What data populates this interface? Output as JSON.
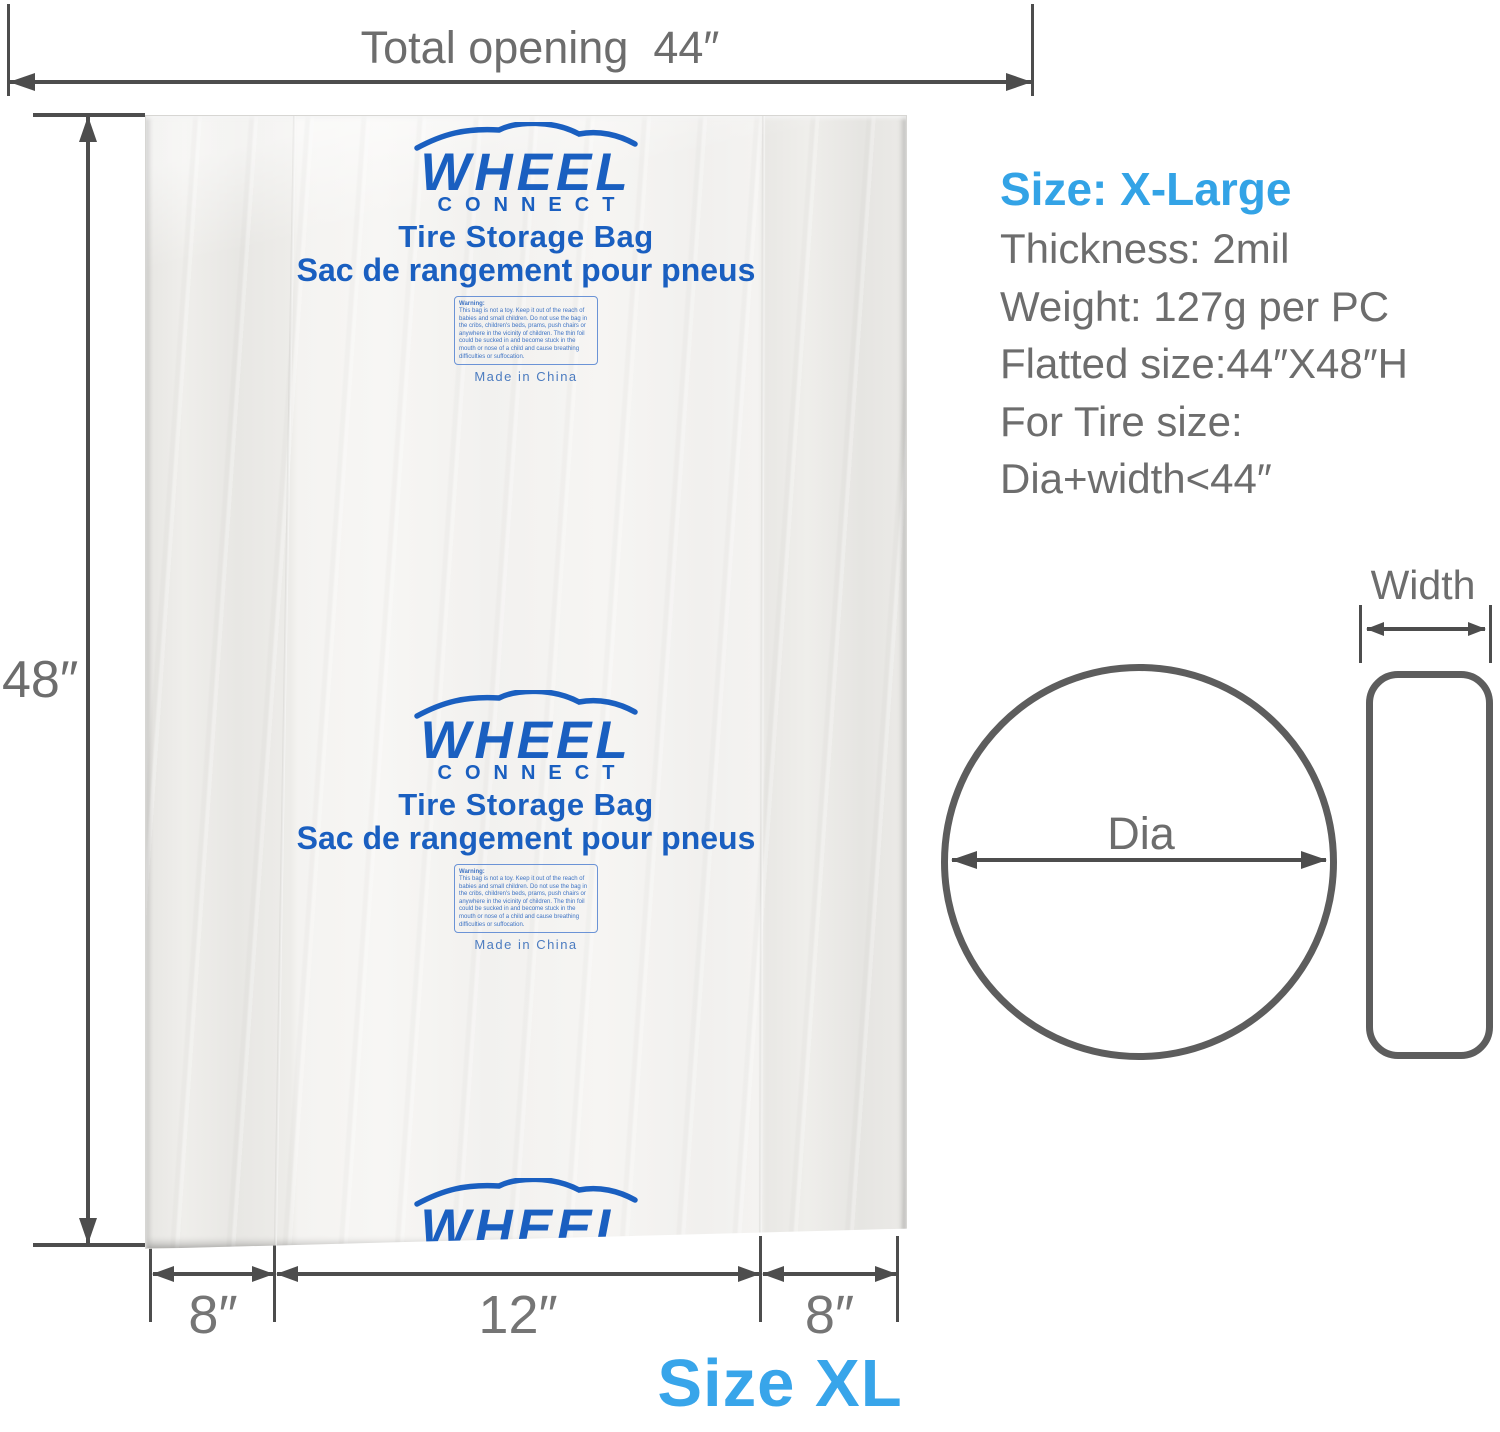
{
  "top_dimension": {
    "label": "Total opening  44″"
  },
  "left_dimension": {
    "label": "48″"
  },
  "bag": {
    "logo": {
      "brand": "WHEEL",
      "sub_brand": "CONNECT",
      "product_en": "Tire Storage Bag",
      "product_fr": "Sac de rangement pour pneus",
      "warning_title": "Warning:",
      "warning_text": "This bag is not a toy. Keep it out of the reach of babies and small children. Do not use the bag in the cribs, children's beds, prams, push chairs or anywhere in the vicinity of children. The thin foil could be sucked in and become stuck in the mouth or nose of a child and cause breathing difficulties or suffocation.",
      "origin": "Made in China"
    }
  },
  "bottom_dimension": {
    "left": "8″",
    "middle": "12″",
    "right": "8″"
  },
  "size_caption": "Size XL",
  "specs": {
    "size_label": "Size: X-Large",
    "lines": [
      "Thickness: 2mil",
      "Weight: 127g per PC",
      "Flatted size:44″X48″H",
      "For Tire size:",
      "Dia+width<44″"
    ]
  },
  "tire_diagram": {
    "width_label": "Width",
    "dia_label": "Dia"
  },
  "colors": {
    "brand_blue": "#1a5fc0",
    "accent_blue": "#38a5ea",
    "text_gray": "#6d6d6d",
    "line_gray": "#4d4d4d"
  }
}
